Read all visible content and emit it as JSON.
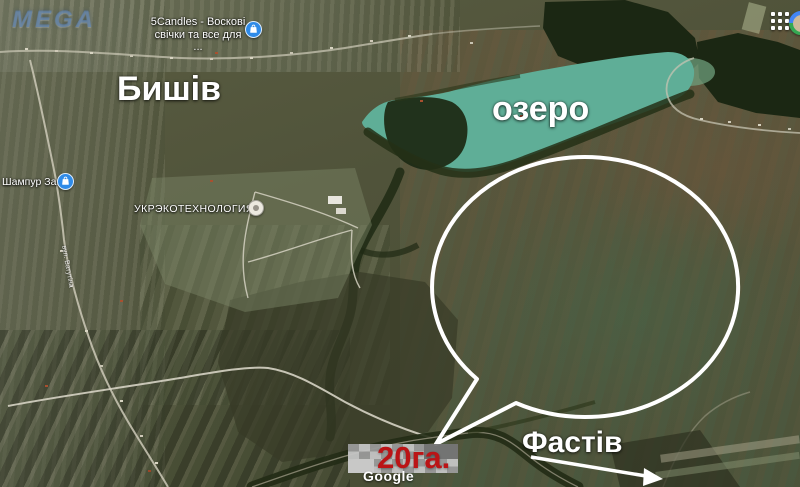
{
  "topbar": {
    "apps_icon": "apps-grid-icon",
    "avatar_icon": "google-account-avatar"
  },
  "watermark": {
    "text": "MEGA"
  },
  "map_labels": {
    "town": "Бишів",
    "lake": "озеро",
    "direction": "Фастів",
    "area": "20га.",
    "street": "вул. Ватутіна"
  },
  "pois": [
    {
      "line1": "5Candles - Воскові",
      "line2": "свічки та все для ...",
      "icon": "shopping-bag-icon"
    },
    {
      "label": "Шампур Занят",
      "icon": "shopping-bag-icon"
    },
    {
      "label": "УКРЭКОТЕХНОЛОГИЯ",
      "icon": "generic-poi-icon"
    }
  ],
  "attribution": {
    "logo": "Google"
  },
  "colors": {
    "lake": "#5fae97",
    "forest": "#1b2713",
    "annotation": "#ffffff",
    "area_text": "#bb1416",
    "poi_pin_blue": "#2f8be8"
  }
}
